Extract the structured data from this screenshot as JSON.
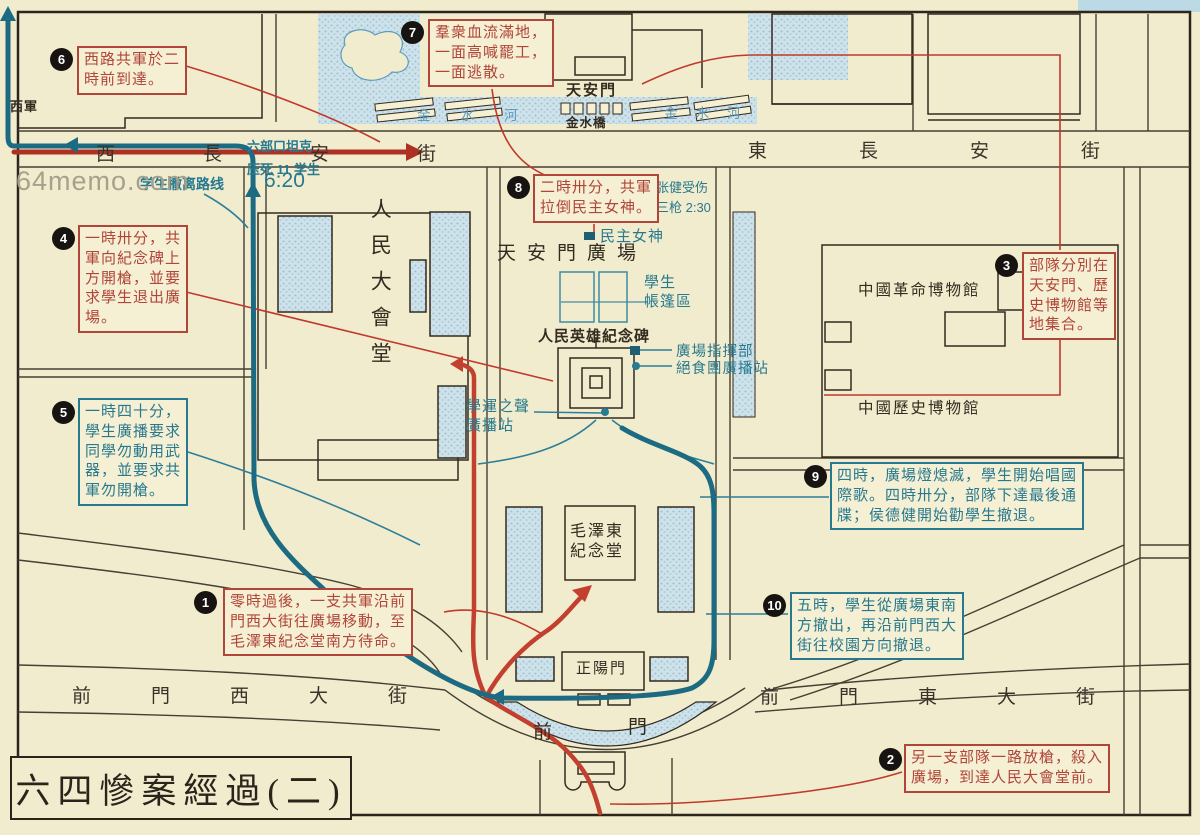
{
  "title": "六四慘案經過(二)",
  "watermark": "64memo.com",
  "annotations": {
    "a1": {
      "num": "1",
      "text": "零時過後，一支共軍沿前\n門西大街往廣場移動，至\n毛澤東紀念堂南方待命。"
    },
    "a2": {
      "num": "2",
      "text": "另一支部隊一路放槍，殺入\n廣場，到達人民大會堂前。"
    },
    "a3": {
      "num": "3",
      "text": "部隊分別在\n天安門、歷\n史博物館等\n地集合。"
    },
    "a4": {
      "num": "4",
      "text": "一時卅分，共\n軍向紀念碑上\n方開槍，並要\n求學生退出廣\n場。"
    },
    "a5": {
      "num": "5",
      "text": "一時四十分，\n學生廣播要求\n同學勿動用武\n器，並要求共\n軍勿開槍。"
    },
    "a6": {
      "num": "6",
      "text": "西路共軍於二\n時前到達。"
    },
    "a7": {
      "num": "7",
      "text": "羣衆血流滿地，\n一面高喊罷工，\n一面逃散。"
    },
    "a8": {
      "num": "8",
      "text": "二時卅分，共軍\n拉倒民主女神。"
    },
    "a9": {
      "num": "9",
      "text": "四時，廣場燈熄滅，學生開始唱國\n際歌。四時卅分，部隊下達最後通\n牒；侯德健開始勸學生撤退。"
    },
    "a10": {
      "num": "10",
      "text": "五時，學生從廣場東南\n方撤出，再沿前門西大\n街往校園方向撤退。"
    }
  },
  "labels": {
    "tiananmen_gate": "天安門",
    "jinshui_bridge": "金水橋",
    "jinshui_river_left": "金水河",
    "jinshui_river_right": "金水河",
    "square": "天安門廣場",
    "great_hall": "人民大會堂",
    "monument": "人民英雄紀念碑",
    "museum_revolution": "中國革命博物館",
    "museum_history": "中國歷史博物館",
    "mao_hall": "毛澤東\n紀念堂",
    "zhengyangmen": "正陽門",
    "qianmen_front": "前",
    "qianmen_gate": "門",
    "west_army": "西軍",
    "goddess": "民主女神",
    "tents": "學生\n帳篷區",
    "voice_station": "學運之聲\n廣播站",
    "command_post": "廣場指揮部",
    "hunger_station": "絕食團廣播站"
  },
  "streets": {
    "west_changan": "西長安街",
    "east_changan": "東長安街",
    "qianmen_west": "前門西大街",
    "qianmen_east": "前門東大街"
  },
  "notes": {
    "zhangjian": "张健受伤\n三枪 2:30",
    "liubukou": "六部口坦克\n压死 11 学生",
    "time620": "6:20",
    "retreat_route": "学生撤离路线"
  }
}
